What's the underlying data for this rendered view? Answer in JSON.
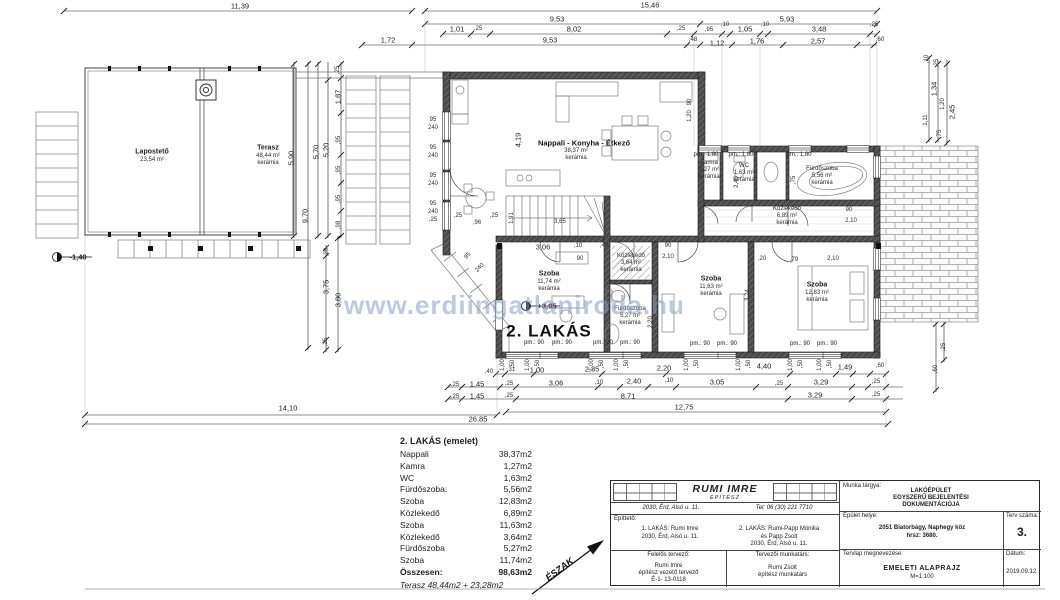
{
  "watermark": {
    "text": "www.erdiingatlaniroda.hu"
  },
  "room_list": {
    "title": "2. LAKÁS (emelet)",
    "rows": [
      {
        "name": "Nappali",
        "area": "38,37m2"
      },
      {
        "name": "Kamra",
        "area": "1,27m2"
      },
      {
        "name": "WC",
        "area": "1,63m2"
      },
      {
        "name": "Fürdőszoba:",
        "area": "5,56m2"
      },
      {
        "name": "Szoba",
        "area": "12,83m2"
      },
      {
        "name": "Közlekedő",
        "area": "6,89m2"
      },
      {
        "name": "Szoba",
        "area": "11,63m2"
      },
      {
        "name": "Közlekedő",
        "area": "3,64m2"
      },
      {
        "name": "Fürdőszoba",
        "area": "5,27m2"
      },
      {
        "name": "Szoba",
        "area": "11,74m2"
      }
    ],
    "total_label": "Összesen:",
    "total_value": "98,63m2",
    "terasz_note": "Terasz  48,44m2 + 23,28m2"
  },
  "title_block": {
    "architect_name": "RUMI  IMRE",
    "architect_title": "ÉPÍTÉSZ",
    "architect_address": "2030, Érd, Alsó u. 11.",
    "architect_phone": "Tel: 06 (30) 221 7710",
    "client_label": "Építtető:",
    "client1_line1": "1. LAKÁS: Rumi Imre",
    "client1_line2": "2030, Érd, Alsó u. 11.",
    "client2_line1": "2. LAKÁS: Rumi-Papp Mónika",
    "client2_line2": "és Papp Zsolt",
    "client2_line3": "2030, Érd, Alsó u. 11.",
    "designer_label": "Felelős tervező:",
    "designer_name": "Rumi Imre",
    "designer_role": "építész vezető tervező",
    "designer_id": "É-1- 13-0118",
    "collab_label": "Tervezői munkatárs:",
    "collab_name": "Rumi Zsolt",
    "collab_role": "építész munkatárs",
    "subject_label": "Munka tárgya:",
    "subject_line1": "LAKÓÉPÜLET",
    "subject_line2": "EGYSZERŰ BEJELENTÉSI",
    "subject_line3": "DOKUMENTÁCIÓJA",
    "location_label": "Épület helye:",
    "location_line1": "2051 Biatorbágy, Naphegy köz",
    "location_line2": "hrsz: 3680.",
    "plan_no_label": "Terv száma:",
    "plan_no": "3.",
    "sheet_label": "Tervlap megnevezése:",
    "sheet_name": "EMELETI  ALAPRAJZ",
    "sheet_scale": "M=1:100",
    "date_label": "Dátum:",
    "date": "2019.09.12."
  },
  "plan": {
    "labels": [
      {
        "t": "11,39",
        "x": 240,
        "y": 6
      },
      {
        "t": "15,46",
        "x": 650,
        "y": 5
      },
      {
        "t": "9,53",
        "x": 557,
        "y": 19
      },
      {
        "t": "5,93",
        "x": 787,
        "y": 19
      },
      {
        "t": "1,01",
        "x": 457,
        "y": 29
      },
      {
        "t": ",25",
        "x": 478,
        "y": 29,
        "c": "tiny"
      },
      {
        "t": "8,02",
        "x": 574,
        "y": 29
      },
      {
        "t": ",25",
        "x": 681,
        "y": 29,
        "c": "tiny"
      },
      {
        "t": ",95",
        "x": 709,
        "y": 30,
        "c": "tiny"
      },
      {
        "t": ",10",
        "x": 725,
        "y": 25,
        "c": "tiny"
      },
      {
        "t": "1,05",
        "x": 745,
        "y": 29
      },
      {
        "t": ",10",
        "x": 765,
        "y": 25,
        "c": "tiny"
      },
      {
        "t": "3,48",
        "x": 819,
        "y": 29
      },
      {
        "t": ",25",
        "x": 874,
        "y": 25,
        "c": "tiny"
      },
      {
        "t": "1,72",
        "x": 388,
        "y": 40
      },
      {
        "t": "9,53",
        "x": 550,
        "y": 40
      },
      {
        "t": ",48",
        "x": 693,
        "y": 40,
        "c": "tiny"
      },
      {
        "t": "1,12",
        "x": 717,
        "y": 43
      },
      {
        "t": "1,76",
        "x": 757,
        "y": 41
      },
      {
        "t": "2,57",
        "x": 818,
        "y": 41
      },
      {
        "t": ",60",
        "x": 880,
        "y": 40,
        "c": "tiny"
      },
      {
        "t": "5,90",
        "x": 291,
        "y": 158,
        "r": -90
      },
      {
        "t": "9,70",
        "x": 305,
        "y": 216,
        "r": -90
      },
      {
        "t": "5,70",
        "x": 316,
        "y": 152,
        "r": -90
      },
      {
        "t": "5,20",
        "x": 326,
        "y": 150,
        "r": -90
      },
      {
        "t": ",25",
        "x": 338,
        "y": 70,
        "r": -90,
        "c": "tiny"
      },
      {
        "t": "1,87",
        "x": 338,
        "y": 97,
        "r": -90
      },
      {
        "t": ",95",
        "x": 339,
        "y": 140,
        "r": -90,
        "c": "tiny"
      },
      {
        "t": ",95",
        "x": 339,
        "y": 170,
        "r": -90,
        "c": "tiny"
      },
      {
        "t": ",95",
        "x": 339,
        "y": 199,
        "r": -90,
        "c": "tiny"
      },
      {
        "t": ",98",
        "x": 339,
        "y": 225,
        "r": -90,
        "c": "tiny"
      },
      {
        "t": "95",
        "x": 433,
        "y": 120,
        "c": "tiny"
      },
      {
        "t": "240",
        "x": 433,
        "y": 128,
        "c": "tiny"
      },
      {
        "t": "95",
        "x": 433,
        "y": 148,
        "c": "tiny"
      },
      {
        "t": "240",
        "x": 433,
        "y": 156,
        "c": "tiny"
      },
      {
        "t": "95",
        "x": 433,
        "y": 176,
        "c": "tiny"
      },
      {
        "t": "240",
        "x": 433,
        "y": 184,
        "c": "tiny"
      },
      {
        "t": "95",
        "x": 433,
        "y": 204,
        "c": "tiny"
      },
      {
        "t": "240",
        "x": 433,
        "y": 212,
        "c": "tiny"
      },
      {
        "t": ",25",
        "x": 433,
        "y": 220,
        "c": "tiny"
      },
      {
        "t": ",25",
        "x": 458,
        "y": 216,
        "c": "tiny"
      },
      {
        "t": ",96",
        "x": 477,
        "y": 223,
        "c": "tiny"
      },
      {
        "t": ",25",
        "x": 494,
        "y": 216,
        "c": "tiny"
      },
      {
        "t": "4,19",
        "x": 518,
        "y": 140,
        "r": -90
      },
      {
        "t": "1,91",
        "x": 512,
        "y": 218,
        "r": -90,
        "c": "tiny"
      },
      {
        "t": "3,65",
        "x": 560,
        "y": 222,
        "c": "tiny"
      },
      {
        "t": "3,06",
        "x": 543,
        "y": 247
      },
      {
        "t": ",10",
        "x": 578,
        "y": 246,
        "c": "tiny"
      },
      {
        "t": ",49",
        "x": 604,
        "y": 246,
        "c": "tiny"
      },
      {
        "t": "90",
        "x": 580,
        "y": 259,
        "c": "tiny"
      },
      {
        "t": "Lapostető",
        "x": 152,
        "y": 152,
        "c": "room",
        "n": "room-label-laposteto"
      },
      {
        "t": "23,54 m²",
        "x": 152,
        "y": 160,
        "c": "tiny"
      },
      {
        "t": "Terasz",
        "x": 268,
        "y": 148,
        "c": "room",
        "n": "room-label-terasz"
      },
      {
        "t": "48,44 m²",
        "x": 268,
        "y": 156,
        "c": "tiny"
      },
      {
        "t": "kerámia",
        "x": 268,
        "y": 163,
        "c": "tiny"
      },
      {
        "t": "Nappali - Konyha - Étkező",
        "x": 584,
        "y": 143,
        "c": "roomb",
        "n": "room-label-nappali"
      },
      {
        "t": "38,37 m²",
        "x": 576,
        "y": 151,
        "c": "tiny"
      },
      {
        "t": "kerámia",
        "x": 576,
        "y": 158,
        "c": "tiny"
      },
      {
        "t": "Kamra",
        "x": 709,
        "y": 163,
        "c": "tiny",
        "n": "room-label-kamra"
      },
      {
        "t": "1,27 m²",
        "x": 709,
        "y": 170,
        "c": "tiny"
      },
      {
        "t": "kerámia",
        "x": 709,
        "y": 177,
        "c": "tiny"
      },
      {
        "t": "WC",
        "x": 744,
        "y": 166,
        "c": "tiny",
        "n": "room-label-wc"
      },
      {
        "t": "1,63 m²",
        "x": 744,
        "y": 173,
        "c": "tiny"
      },
      {
        "t": "kerámia",
        "x": 744,
        "y": 180,
        "c": "tiny"
      },
      {
        "t": "Fürdőszoba",
        "x": 822,
        "y": 169,
        "c": "tiny",
        "n": "room-label-furdoszoba-1"
      },
      {
        "t": "5,56 m²",
        "x": 822,
        "y": 176,
        "c": "tiny"
      },
      {
        "t": "kerámia",
        "x": 822,
        "y": 183,
        "c": "tiny"
      },
      {
        "t": "Közlekedő",
        "x": 787,
        "y": 209,
        "c": "tiny",
        "n": "room-label-kozlekedo-1"
      },
      {
        "t": "6,89 m²",
        "x": 787,
        "y": 216,
        "c": "tiny"
      },
      {
        "t": "kerámia",
        "x": 787,
        "y": 223,
        "c": "tiny"
      },
      {
        "t": "Szoba",
        "x": 549,
        "y": 274,
        "c": "room",
        "n": "room-label-szoba-1"
      },
      {
        "t": "11,74 m²",
        "x": 549,
        "y": 282,
        "c": "tiny"
      },
      {
        "t": "kerámia",
        "x": 549,
        "y": 289,
        "c": "tiny"
      },
      {
        "t": "Közlekedő",
        "x": 631,
        "y": 256,
        "c": "tiny",
        "n": "room-label-kozlekedo-2"
      },
      {
        "t": "3,64 m²",
        "x": 631,
        "y": 263,
        "c": "tiny"
      },
      {
        "t": "kerámia",
        "x": 631,
        "y": 270,
        "c": "tiny"
      },
      {
        "t": "Fürdőszoba",
        "x": 630,
        "y": 309,
        "c": "tiny",
        "n": "room-label-furdoszoba-2"
      },
      {
        "t": "5,27 m²",
        "x": 630,
        "y": 316,
        "c": "tiny"
      },
      {
        "t": "kerámia",
        "x": 630,
        "y": 323,
        "c": "tiny"
      },
      {
        "t": "Szoba",
        "x": 711,
        "y": 279,
        "c": "room",
        "n": "room-label-szoba-2"
      },
      {
        "t": "11,63 m²",
        "x": 711,
        "y": 287,
        "c": "tiny"
      },
      {
        "t": "kerámia",
        "x": 711,
        "y": 294,
        "c": "tiny"
      },
      {
        "t": "Szoba",
        "x": 817,
        "y": 285,
        "c": "room",
        "n": "room-label-szoba-3"
      },
      {
        "t": "12,83 m²",
        "x": 817,
        "y": 293,
        "c": "tiny"
      },
      {
        "t": "kerámia",
        "x": 817,
        "y": 300,
        "c": "tiny"
      },
      {
        "t": "2. LAKÁS",
        "x": 549,
        "y": 331,
        "c": "big",
        "n": "apartment-label"
      },
      {
        "t": "pm.: 1,80",
        "x": 706,
        "y": 155,
        "c": "pm"
      },
      {
        "t": "pm.: 1,80",
        "x": 741,
        "y": 155,
        "c": "pm"
      },
      {
        "t": "pm.: 1,80",
        "x": 799,
        "y": 155,
        "c": "pm"
      },
      {
        "t": "pm.: 90",
        "x": 534,
        "y": 343,
        "c": "pm"
      },
      {
        "t": "pm.: 90",
        "x": 562,
        "y": 343,
        "c": "pm"
      },
      {
        "t": "pm.: 90",
        "x": 603,
        "y": 343,
        "c": "pm"
      },
      {
        "t": "pm.: 90",
        "x": 630,
        "y": 343,
        "c": "pm"
      },
      {
        "t": "pm.: 90",
        "x": 700,
        "y": 344,
        "c": "pm"
      },
      {
        "t": "pm.: 90",
        "x": 727,
        "y": 344,
        "c": "pm"
      },
      {
        "t": "pm.: 90",
        "x": 800,
        "y": 344,
        "c": "pm"
      },
      {
        "t": "pm.: 90",
        "x": 827,
        "y": 344,
        "c": "pm"
      },
      {
        "t": "2,40",
        "x": 737,
        "y": 182,
        "r": -90,
        "c": "tiny"
      },
      {
        "t": ",75",
        "x": 794,
        "y": 180,
        "r": -90,
        "c": "tiny"
      },
      {
        "t": "90",
        "x": 849,
        "y": 210,
        "c": "tiny"
      },
      {
        "t": "2,10",
        "x": 851,
        "y": 221,
        "c": "tiny"
      },
      {
        "t": "90",
        "x": 690,
        "y": 102,
        "r": -90,
        "c": "tiny"
      },
      {
        "t": "1,20",
        "x": 690,
        "y": 116,
        "r": -90,
        "c": "tiny"
      },
      {
        "t": "3,24",
        "x": 748,
        "y": 295,
        "r": -90,
        "c": "tiny"
      },
      {
        "t": "2,20",
        "x": 651,
        "y": 322,
        "r": -90,
        "c": "tiny"
      },
      {
        "t": ",20",
        "x": 762,
        "y": 259,
        "c": "tiny"
      },
      {
        "t": ",79",
        "x": 794,
        "y": 260,
        "c": "tiny"
      },
      {
        "t": "2,10",
        "x": 833,
        "y": 259,
        "c": "tiny"
      },
      {
        "t": "90",
        "x": 668,
        "y": 246,
        "c": "tiny"
      },
      {
        "t": "2,10",
        "x": 668,
        "y": 257,
        "c": "tiny"
      },
      {
        "t": "95",
        "x": 468,
        "y": 256,
        "r": -45,
        "c": "tiny"
      },
      {
        "t": "240",
        "x": 480,
        "y": 268,
        "r": -45,
        "c": "tiny"
      },
      {
        "t": ",10",
        "x": 927,
        "y": 59,
        "r": -90,
        "c": "tiny"
      },
      {
        "t": ",25",
        "x": 937,
        "y": 63,
        "r": -90,
        "c": "tiny"
      },
      {
        "t": "1,34",
        "x": 934,
        "y": 89,
        "r": -90
      },
      {
        "t": "1,20",
        "x": 943,
        "y": 104,
        "r": -90,
        "c": "tiny"
      },
      {
        "t": "2,45",
        "x": 952,
        "y": 112,
        "r": -90
      },
      {
        "t": "1,11",
        "x": 926,
        "y": 120,
        "r": -90,
        "c": "tiny"
      },
      {
        "t": ",75",
        "x": 940,
        "y": 134,
        "r": -90,
        "c": "tiny"
      },
      {
        "t": ",25",
        "x": 944,
        "y": 347,
        "r": -90,
        "c": "tiny"
      },
      {
        "t": ",60",
        "x": 936,
        "y": 369,
        "r": -90,
        "c": "tiny"
      },
      {
        "t": ",40",
        "x": 489,
        "y": 372,
        "c": "tiny"
      },
      {
        "t": ",31",
        "x": 511,
        "y": 370,
        "c": "tiny"
      },
      {
        "t": "1,00",
        "x": 537,
        "y": 370
      },
      {
        "t": "2,35",
        "x": 592,
        "y": 369
      },
      {
        "t": "2,20",
        "x": 664,
        "y": 368
      },
      {
        "t": "4,40",
        "x": 764,
        "y": 366
      },
      {
        "t": "1,49",
        "x": 845,
        "y": 367
      },
      {
        "t": ",60",
        "x": 880,
        "y": 366,
        "c": "tiny"
      },
      {
        "t": ",25",
        "x": 455,
        "y": 385,
        "c": "tiny"
      },
      {
        "t": "1,45",
        "x": 477,
        "y": 384
      },
      {
        "t": ",25",
        "x": 509,
        "y": 384,
        "c": "tiny"
      },
      {
        "t": "3,06",
        "x": 556,
        "y": 383
      },
      {
        "t": ",10",
        "x": 599,
        "y": 383,
        "c": "tiny"
      },
      {
        "t": "2,40",
        "x": 634,
        "y": 381
      },
      {
        "t": ",10",
        "x": 669,
        "y": 381,
        "c": "tiny"
      },
      {
        "t": "3,05",
        "x": 717,
        "y": 382
      },
      {
        "t": ",25",
        "x": 779,
        "y": 384,
        "c": "tiny"
      },
      {
        "t": "3,29",
        "x": 821,
        "y": 382
      },
      {
        "t": ",25",
        "x": 876,
        "y": 382,
        "c": "tiny"
      },
      {
        "t": ",25",
        "x": 455,
        "y": 397,
        "c": "tiny"
      },
      {
        "t": "1,45",
        "x": 477,
        "y": 396
      },
      {
        "t": ",25",
        "x": 509,
        "y": 396,
        "c": "tiny"
      },
      {
        "t": "8,71",
        "x": 628,
        "y": 396
      },
      {
        "t": "3,29",
        "x": 815,
        "y": 395
      },
      {
        "t": ",25",
        "x": 876,
        "y": 395,
        "c": "tiny"
      },
      {
        "t": "12,75",
        "x": 684,
        "y": 407
      },
      {
        "t": "14,10",
        "x": 288,
        "y": 408
      },
      {
        "t": "26,85",
        "x": 478,
        "y": 419
      },
      {
        "t": ",20",
        "x": 327,
        "y": 252,
        "r": -90,
        "c": "tiny"
      },
      {
        "t": "3,75",
        "x": 326,
        "y": 287,
        "r": -90
      },
      {
        "t": "3,80",
        "x": 338,
        "y": 300,
        "r": -90
      },
      {
        "t": ",25",
        "x": 326,
        "y": 342,
        "r": -90,
        "c": "tiny"
      },
      {
        "t": "1,00",
        "x": 503,
        "y": 365,
        "r": -90,
        "c": "tiny"
      },
      {
        "t": ",50",
        "x": 513,
        "y": 364,
        "r": -90,
        "c": "tiny"
      },
      {
        "t": "1,00",
        "x": 528,
        "y": 365,
        "r": -90,
        "c": "tiny"
      },
      {
        "t": ",50",
        "x": 538,
        "y": 364,
        "r": -90,
        "c": "tiny"
      },
      {
        "t": "1,00",
        "x": 592,
        "y": 365,
        "r": -90,
        "c": "tiny"
      },
      {
        "t": ",50",
        "x": 602,
        "y": 364,
        "r": -90,
        "c": "tiny"
      },
      {
        "t": "1,00",
        "x": 617,
        "y": 365,
        "r": -90,
        "c": "tiny"
      },
      {
        "t": ",50",
        "x": 627,
        "y": 364,
        "r": -90,
        "c": "tiny"
      },
      {
        "t": "1,00",
        "x": 687,
        "y": 365,
        "r": -90,
        "c": "tiny"
      },
      {
        "t": ",50",
        "x": 697,
        "y": 364,
        "r": -90,
        "c": "tiny"
      },
      {
        "t": "1,00",
        "x": 739,
        "y": 365,
        "r": -90,
        "c": "tiny"
      },
      {
        "t": ",50",
        "x": 749,
        "y": 364,
        "r": -90,
        "c": "tiny"
      },
      {
        "t": "1,00",
        "x": 791,
        "y": 365,
        "r": -90,
        "c": "tiny"
      },
      {
        "t": ",50",
        "x": 801,
        "y": 364,
        "r": -90,
        "c": "tiny"
      },
      {
        "t": "1,00",
        "x": 820,
        "y": 365,
        "r": -90,
        "c": "tiny"
      },
      {
        "t": ",50",
        "x": 830,
        "y": 364,
        "r": -90,
        "c": "tiny"
      },
      {
        "t": "-1,40",
        "x": 78,
        "y": 257,
        "c": "lvl",
        "n": "level-marker-label"
      },
      {
        "t": "+3,05",
        "x": 547,
        "y": 306,
        "c": "lvl",
        "n": "level-marker-label"
      },
      {
        "t": "ÉSZAK",
        "x": 560,
        "y": 570,
        "r": -37,
        "c": "north",
        "n": "north-label"
      }
    ]
  }
}
